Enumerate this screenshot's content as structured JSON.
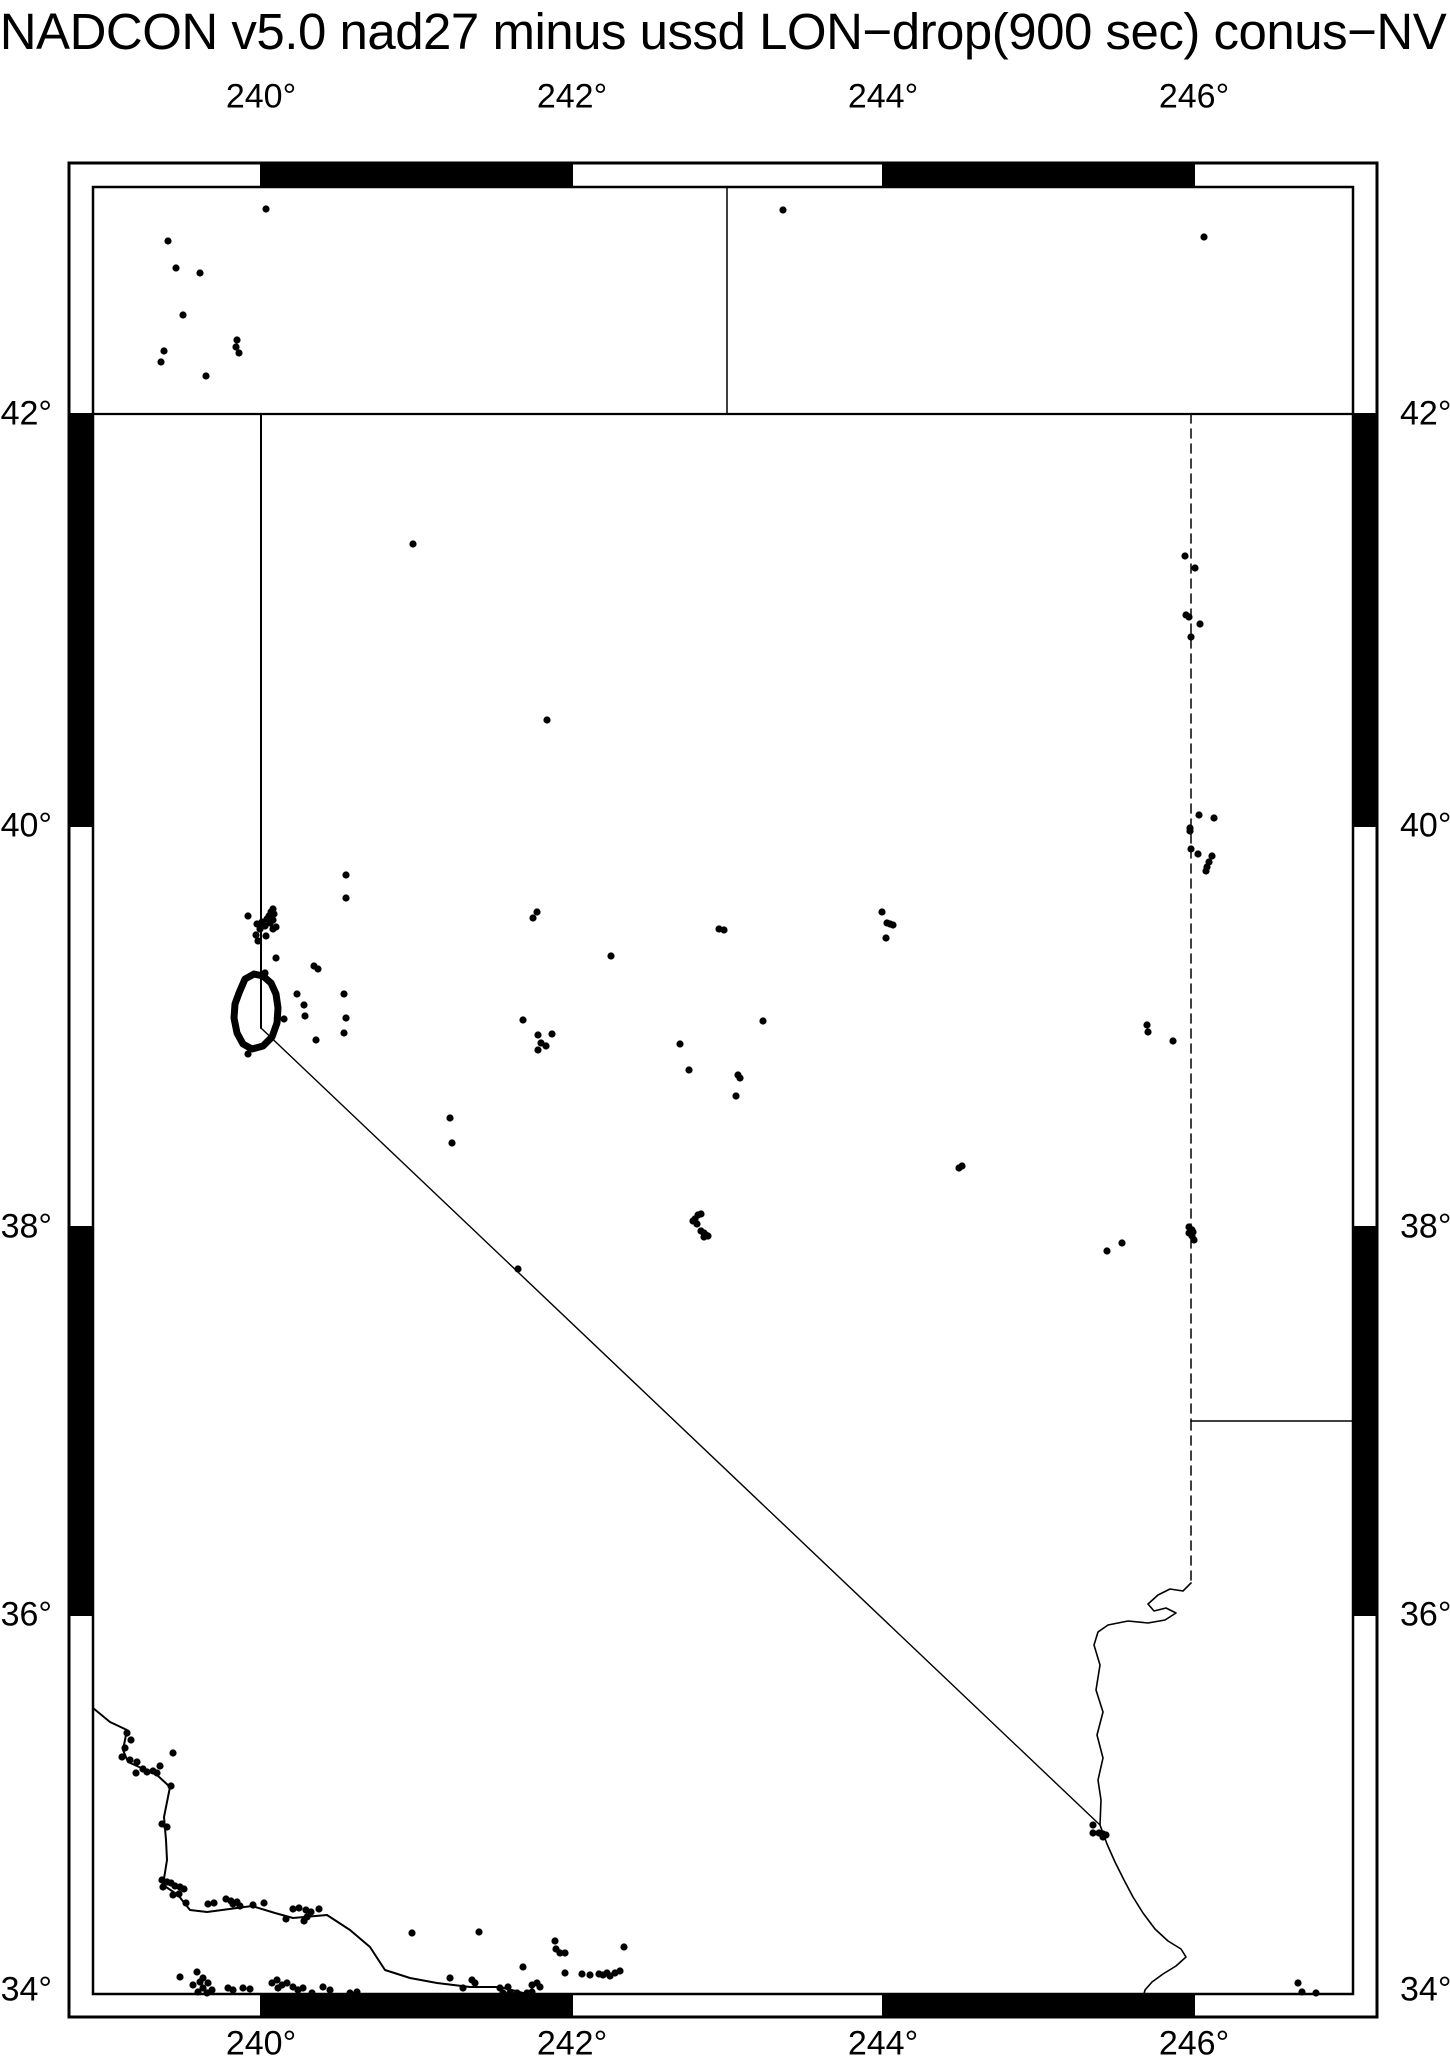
{
  "title": "NADCON v5.0 nad27 minus ussd LON−drop(900 sec) conus−NV",
  "colors": {
    "ink": "#000000",
    "paper": "#ffffff"
  },
  "canvas": {
    "width": 1450,
    "height": 2068
  },
  "frame": {
    "outer": {
      "x1": 69,
      "y1": 163,
      "x2": 1377,
      "y2": 2017
    },
    "inner": {
      "x1": 93,
      "y1": 187,
      "x2": 1353,
      "y2": 1994
    },
    "outer_stroke": 3,
    "inner_stroke": 2.5,
    "band_black_topbottom": [
      [
        261,
        572
      ],
      [
        883,
        1194
      ]
    ],
    "band_black_leftright": [
      [
        414,
        826
      ],
      [
        1227,
        1615
      ]
    ],
    "separators_x": [
      261,
      572,
      883,
      1194
    ],
    "separators_y": [
      414,
      826,
      1227,
      1615
    ]
  },
  "axes": {
    "top": {
      "y": 97,
      "ticks": [
        {
          "label": "240°",
          "x": 261
        },
        {
          "label": "242°",
          "x": 572
        },
        {
          "label": "244°",
          "x": 883
        },
        {
          "label": "246°",
          "x": 1194
        }
      ]
    },
    "bottom": {
      "y": 2044,
      "ticks": [
        {
          "label": "240°",
          "x": 261
        },
        {
          "label": "242°",
          "x": 572
        },
        {
          "label": "244°",
          "x": 883
        },
        {
          "label": "246°",
          "x": 1194
        }
      ]
    },
    "left": {
      "x": 52,
      "ticks": [
        {
          "label": "42°",
          "y": 414
        },
        {
          "label": "40°",
          "y": 826
        },
        {
          "label": "38°",
          "y": 1227
        },
        {
          "label": "36°",
          "y": 1615
        },
        {
          "label": "34°",
          "y": 1990
        }
      ]
    },
    "right": {
      "x": 1400,
      "ticks": [
        {
          "label": "42°",
          "y": 414
        },
        {
          "label": "40°",
          "y": 826
        },
        {
          "label": "38°",
          "y": 1227
        },
        {
          "label": "36°",
          "y": 1615
        },
        {
          "label": "34°",
          "y": 1990
        }
      ]
    }
  },
  "projection_note": "Mercator, lon 240-246E labeled every 2 deg, lat 34-42N labeled every 2 deg",
  "map_lines": [
    {
      "name": "parallel-42N-border",
      "width": 2.2,
      "dash": null,
      "pts": [
        [
          93,
          414
        ],
        [
          1353,
          414
        ]
      ]
    },
    {
      "name": "border-oregon-idaho",
      "width": 1.5,
      "dash": null,
      "pts": [
        [
          727,
          187
        ],
        [
          727,
          414
        ]
      ]
    },
    {
      "name": "border-california-nevada-vertical",
      "width": 2,
      "dash": null,
      "pts": [
        [
          261,
          414
        ],
        [
          261,
          1028
        ]
      ]
    },
    {
      "name": "border-california-nevada-diagonal",
      "width": 1.4,
      "dash": null,
      "pts": [
        [
          261,
          1028
        ],
        [
          1100,
          1825
        ]
      ]
    },
    {
      "name": "border-nevada-utah",
      "width": 1.5,
      "dash": "9,6",
      "pts": [
        [
          1191,
          414
        ],
        [
          1191,
          1421
        ]
      ]
    },
    {
      "name": "border-utah-arizona",
      "width": 1.5,
      "dash": null,
      "pts": [
        [
          1191,
          1421
        ],
        [
          1353,
          1421
        ]
      ]
    },
    {
      "name": "border-nevada-arizona-vertical",
      "width": 1.5,
      "dash": "9,6",
      "pts": [
        [
          1191,
          1421
        ],
        [
          1191,
          1583
        ]
      ]
    },
    {
      "name": "colorado-river",
      "width": 1.6,
      "dash": null,
      "pts": [
        [
          1191,
          1583
        ],
        [
          1183,
          1591
        ],
        [
          1170,
          1589
        ],
        [
          1158,
          1595
        ],
        [
          1148,
          1604
        ],
        [
          1154,
          1611
        ],
        [
          1166,
          1608
        ],
        [
          1176,
          1613
        ],
        [
          1165,
          1620
        ],
        [
          1148,
          1623
        ],
        [
          1128,
          1621
        ],
        [
          1108,
          1625
        ],
        [
          1098,
          1632
        ],
        [
          1094,
          1645
        ],
        [
          1100,
          1665
        ],
        [
          1096,
          1690
        ],
        [
          1103,
          1712
        ],
        [
          1097,
          1735
        ],
        [
          1103,
          1758
        ],
        [
          1098,
          1780
        ],
        [
          1101,
          1800
        ],
        [
          1100,
          1825
        ],
        [
          1107,
          1844
        ],
        [
          1115,
          1862
        ],
        [
          1124,
          1880
        ],
        [
          1133,
          1897
        ],
        [
          1143,
          1913
        ],
        [
          1155,
          1929
        ],
        [
          1168,
          1941
        ],
        [
          1181,
          1949
        ],
        [
          1186,
          1957
        ],
        [
          1176,
          1966
        ],
        [
          1163,
          1974
        ],
        [
          1152,
          1982
        ],
        [
          1145,
          1990
        ],
        [
          1144,
          1994
        ]
      ]
    },
    {
      "name": "pacific-coastline",
      "width": 2,
      "dash": null,
      "pts": [
        [
          93,
          1708
        ],
        [
          110,
          1722
        ],
        [
          127,
          1730
        ],
        [
          123,
          1750
        ],
        [
          128,
          1762
        ],
        [
          157,
          1775
        ],
        [
          170,
          1787
        ],
        [
          164,
          1817
        ],
        [
          166,
          1840
        ],
        [
          167,
          1860
        ],
        [
          163,
          1885
        ],
        [
          178,
          1895
        ],
        [
          190,
          1910
        ],
        [
          207,
          1912
        ],
        [
          252,
          1906
        ],
        [
          275,
          1913
        ],
        [
          293,
          1918
        ],
        [
          327,
          1915
        ],
        [
          350,
          1930
        ],
        [
          370,
          1947
        ],
        [
          385,
          1970
        ],
        [
          410,
          1978
        ],
        [
          437,
          1983
        ],
        [
          470,
          1987
        ],
        [
          500,
          1987
        ],
        [
          527,
          1994
        ]
      ]
    }
  ],
  "lake_tahoe_outline": {
    "stroke_width": 7,
    "pts": [
      [
        239,
        993
      ],
      [
        245,
        979
      ],
      [
        254,
        974
      ],
      [
        263,
        976
      ],
      [
        271,
        983
      ],
      [
        276,
        994
      ],
      [
        278,
        1008
      ],
      [
        277,
        1023
      ],
      [
        272,
        1037
      ],
      [
        263,
        1046
      ],
      [
        252,
        1049
      ],
      [
        243,
        1044
      ],
      [
        237,
        1033
      ],
      [
        234,
        1018
      ],
      [
        235,
        1004
      ],
      [
        239,
        993
      ]
    ]
  },
  "dot_radius": 3.6,
  "dots": [
    [
      266,
      209
    ],
    [
      168,
      241
    ],
    [
      176,
      268
    ],
    [
      200,
      273
    ],
    [
      183,
      315
    ],
    [
      237,
      340
    ],
    [
      236,
      347
    ],
    [
      239,
      353
    ],
    [
      164,
      351
    ],
    [
      161,
      362
    ],
    [
      206,
      376
    ],
    [
      783,
      210
    ],
    [
      1204,
      237
    ],
    [
      413,
      544
    ],
    [
      1185,
      556
    ],
    [
      1195,
      568
    ],
    [
      1186,
      615
    ],
    [
      1189,
      617
    ],
    [
      1200,
      624
    ],
    [
      1191,
      637
    ],
    [
      1199,
      815
    ],
    [
      1214,
      818
    ],
    [
      1190,
      828
    ],
    [
      1190,
      831
    ],
    [
      1191,
      849
    ],
    [
      1198,
      854
    ],
    [
      1212,
      856
    ],
    [
      1209,
      862
    ],
    [
      1207,
      867
    ],
    [
      1206,
      871
    ],
    [
      547,
      720
    ],
    [
      346,
      875
    ],
    [
      346,
      898
    ],
    [
      248,
      916
    ],
    [
      257,
      924
    ],
    [
      262,
      922
    ],
    [
      267,
      919
    ],
    [
      269,
      916
    ],
    [
      271,
      912
    ],
    [
      273,
      909
    ],
    [
      274,
      914
    ],
    [
      273,
      920
    ],
    [
      270,
      923
    ],
    [
      265,
      926
    ],
    [
      260,
      929
    ],
    [
      256,
      935
    ],
    [
      266,
      936
    ],
    [
      273,
      929
    ],
    [
      276,
      927
    ],
    [
      258,
      941
    ],
    [
      276,
      958
    ],
    [
      265,
      973
    ],
    [
      314,
      966
    ],
    [
      318,
      969
    ],
    [
      297,
      994
    ],
    [
      304,
      1005
    ],
    [
      305,
      1016
    ],
    [
      284,
      1019
    ],
    [
      344,
      994
    ],
    [
      346,
      1018
    ],
    [
      344,
      1033
    ],
    [
      316,
      1040
    ],
    [
      248,
      1054
    ],
    [
      533,
      918
    ],
    [
      537,
      912
    ],
    [
      523,
      1020
    ],
    [
      538,
      1035
    ],
    [
      552,
      1034
    ],
    [
      538,
      1050
    ],
    [
      541,
      1043
    ],
    [
      546,
      1046
    ],
    [
      611,
      956
    ],
    [
      719,
      929
    ],
    [
      724,
      930
    ],
    [
      763,
      1021
    ],
    [
      882,
      912
    ],
    [
      887,
      923
    ],
    [
      890,
      924
    ],
    [
      893,
      925
    ],
    [
      886,
      938
    ],
    [
      1147,
      1025
    ],
    [
      1148,
      1032
    ],
    [
      1173,
      1041
    ],
    [
      693,
      1221
    ],
    [
      695,
      1219
    ],
    [
      698,
      1215
    ],
    [
      701,
      1214
    ],
    [
      697,
      1224
    ],
    [
      701,
      1231
    ],
    [
      704,
      1233
    ],
    [
      706,
      1235
    ],
    [
      708,
      1236
    ],
    [
      704,
      1237
    ],
    [
      450,
      1118
    ],
    [
      452,
      1143
    ],
    [
      680,
      1044
    ],
    [
      689,
      1070
    ],
    [
      738,
      1075
    ],
    [
      740,
      1078
    ],
    [
      736,
      1096
    ],
    [
      959,
      1168
    ],
    [
      962,
      1166
    ],
    [
      518,
      1269
    ],
    [
      1107,
      1251
    ],
    [
      1122,
      1243
    ],
    [
      1189,
      1227
    ],
    [
      1192,
      1230
    ],
    [
      1193,
      1232
    ],
    [
      1189,
      1233
    ],
    [
      1192,
      1236
    ],
    [
      1194,
      1240
    ],
    [
      1093,
      1825
    ],
    [
      1093,
      1833
    ],
    [
      1099,
      1833
    ],
    [
      1103,
      1834
    ],
    [
      1103,
      1837
    ],
    [
      1106,
      1835
    ],
    [
      1298,
      1983
    ],
    [
      1302,
      1992
    ],
    [
      1316,
      1993
    ],
    [
      127,
      1733
    ],
    [
      131,
      1740
    ],
    [
      125,
      1748
    ],
    [
      122,
      1757
    ],
    [
      130,
      1760
    ],
    [
      137,
      1762
    ],
    [
      143,
      1769
    ],
    [
      147,
      1772
    ],
    [
      153,
      1771
    ],
    [
      157,
      1773
    ],
    [
      136,
      1773
    ],
    [
      160,
      1766
    ],
    [
      173,
      1753
    ],
    [
      171,
      1786
    ],
    [
      162,
      1824
    ],
    [
      167,
      1827
    ],
    [
      162,
      1880
    ],
    [
      163,
      1887
    ],
    [
      167,
      1882
    ],
    [
      171,
      1883
    ],
    [
      175,
      1886
    ],
    [
      180,
      1887
    ],
    [
      184,
      1889
    ],
    [
      179,
      1894
    ],
    [
      173,
      1895
    ],
    [
      186,
      1903
    ],
    [
      208,
      1904
    ],
    [
      214,
      1903
    ],
    [
      226,
      1899
    ],
    [
      231,
      1901
    ],
    [
      233,
      1904
    ],
    [
      237,
      1902
    ],
    [
      240,
      1906
    ],
    [
      253,
      1905
    ],
    [
      264,
      1903
    ],
    [
      293,
      1909
    ],
    [
      299,
      1908
    ],
    [
      306,
      1910
    ],
    [
      311,
      1912
    ],
    [
      307,
      1917
    ],
    [
      319,
      1909
    ],
    [
      286,
      1919
    ],
    [
      304,
      1921
    ],
    [
      412,
      1933
    ],
    [
      479,
      1932
    ],
    [
      180,
      1977
    ],
    [
      197,
      1972
    ],
    [
      193,
      1985
    ],
    [
      200,
      1982
    ],
    [
      203,
      1978
    ],
    [
      208,
      1983
    ],
    [
      203,
      1988
    ],
    [
      198,
      1992
    ],
    [
      207,
      1993
    ],
    [
      212,
      1990
    ],
    [
      228,
      1988
    ],
    [
      233,
      1990
    ],
    [
      243,
      1988
    ],
    [
      250,
      1989
    ],
    [
      272,
      1983
    ],
    [
      277,
      1980
    ],
    [
      282,
      1985
    ],
    [
      287,
      1983
    ],
    [
      278,
      1988
    ],
    [
      293,
      1987
    ],
    [
      298,
      1990
    ],
    [
      303,
      1988
    ],
    [
      312,
      1993
    ],
    [
      323,
      1987
    ],
    [
      330,
      1990
    ],
    [
      350,
      1993
    ],
    [
      357,
      1992
    ],
    [
      450,
      1978
    ],
    [
      463,
      1988
    ],
    [
      472,
      1980
    ],
    [
      475,
      1983
    ],
    [
      500,
      1988
    ],
    [
      508,
      1987
    ],
    [
      517,
      1993
    ],
    [
      555,
      1941
    ],
    [
      556,
      1949
    ],
    [
      560,
      1953
    ],
    [
      565,
      1953
    ],
    [
      624,
      1947
    ],
    [
      523,
      1967
    ],
    [
      565,
      1973
    ],
    [
      582,
      1974
    ],
    [
      590,
      1975
    ],
    [
      599,
      1974
    ],
    [
      603,
      1975
    ],
    [
      607,
      1973
    ],
    [
      610,
      1976
    ],
    [
      615,
      1973
    ],
    [
      620,
      1971
    ],
    [
      532,
      1985
    ],
    [
      537,
      1983
    ],
    [
      540,
      1987
    ],
    [
      503,
      1993
    ],
    [
      510,
      1993
    ],
    [
      518,
      1994
    ],
    [
      527,
      1993
    ],
    [
      532,
      1992
    ]
  ]
}
